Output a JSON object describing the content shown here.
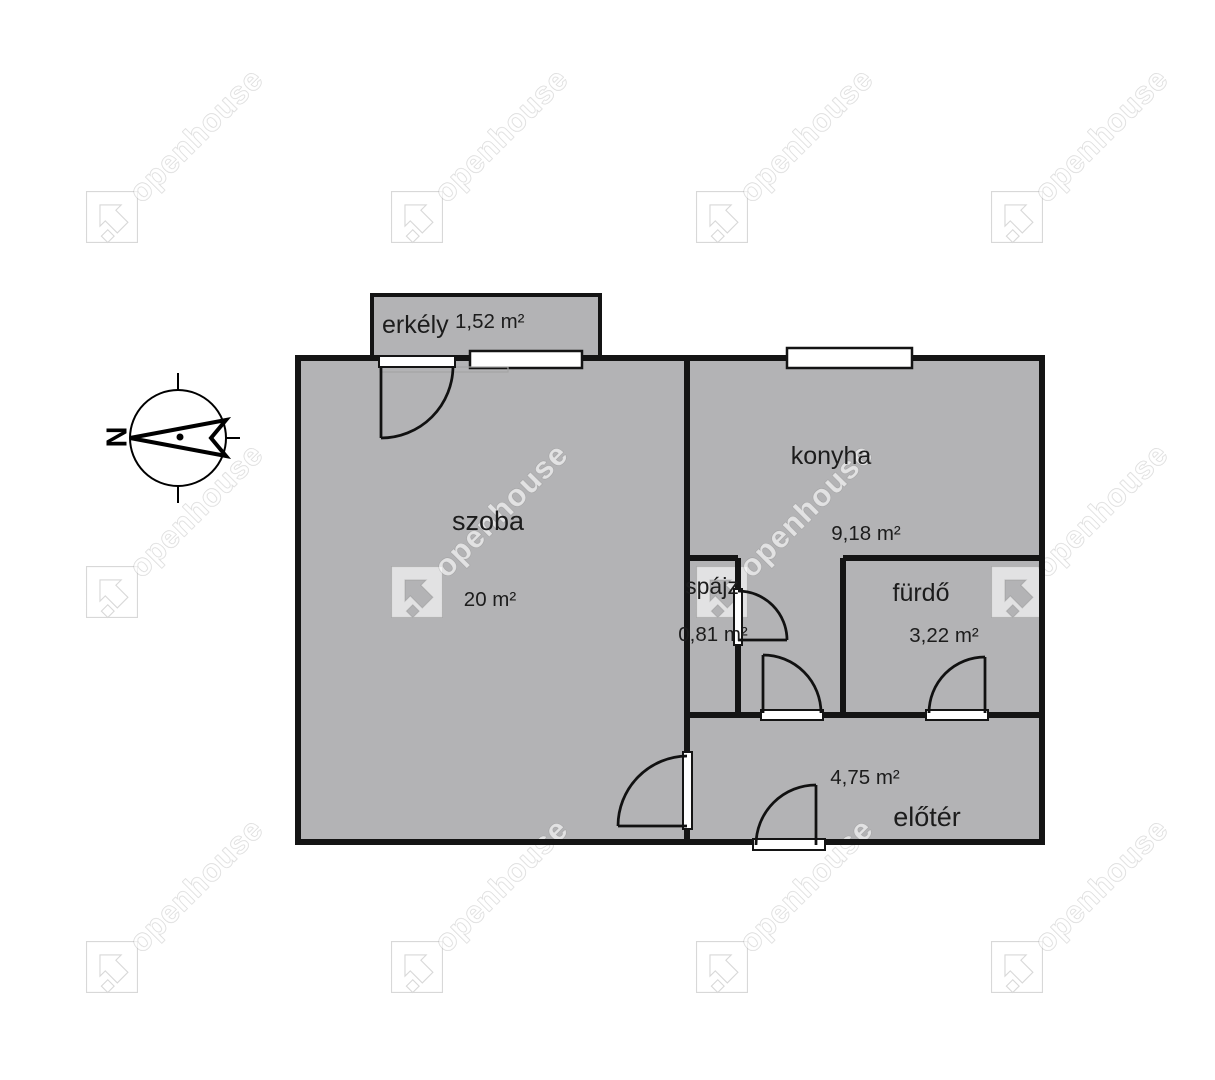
{
  "watermark": {
    "text": "openhouse"
  },
  "compass": {
    "north_label": "N"
  },
  "rooms": {
    "erkely": {
      "label": "erkély",
      "area": "1,52 m²"
    },
    "szoba": {
      "label": "szoba",
      "area": "20 m²"
    },
    "konyha": {
      "label": "konyha",
      "area": "9,18 m²"
    },
    "spajz": {
      "label": "spájz",
      "area": "0,81 m²"
    },
    "furdo": {
      "label": "fürdő",
      "area": "3,22 m²"
    },
    "eloter": {
      "label": "előtér",
      "area": "4,75 m²"
    }
  },
  "colors": {
    "room_fill": "#b3b3b5",
    "wall": "#141414",
    "window": "#ffffff"
  }
}
